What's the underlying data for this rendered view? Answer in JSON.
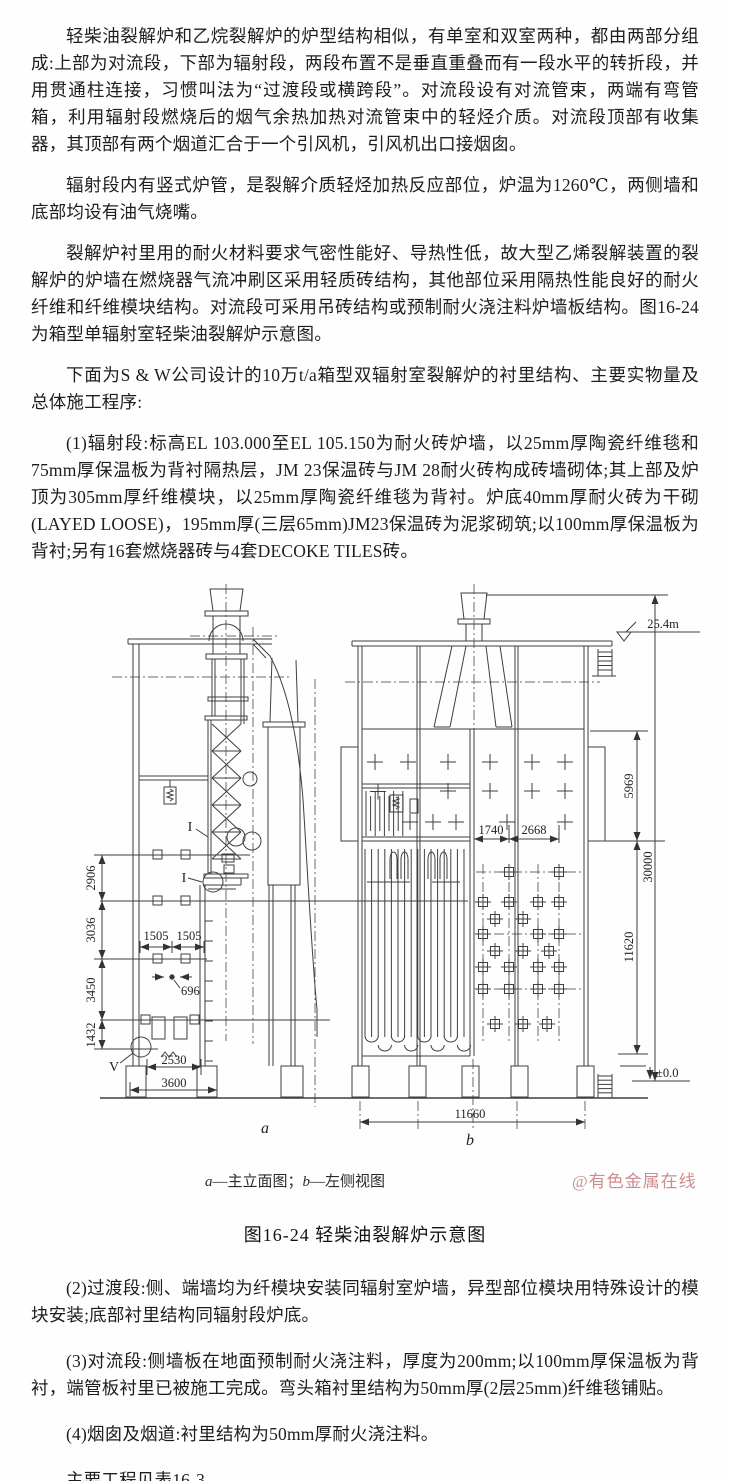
{
  "page": {
    "background": "#fefefe",
    "ink": "#1d1d1d",
    "line_color": "#3f3f3f",
    "watermark_color": "#d08c8c"
  },
  "paragraphs_top": [
    "轻柴油裂解炉和乙烷裂解炉的炉型结构相似，有单室和双室两种，都由两部分组成:上部为对流段，下部为辐射段，两段布置不是垂直重叠而有一段水平的转折段，并用贯通柱连接，习惯叫法为“过渡段或横跨段”。对流段设有对流管束，两端有弯管箱，利用辐射段燃烧后的烟气余热加热对流管束中的轻烃介质。对流段顶部有收集器，其顶部有两个烟道汇合于一个引风机，引风机出口接烟囱。",
    "辐射段内有竖式炉管，是裂解介质轻烃加热反应部位，炉温为1260℃，两侧墙和底部均设有油气烧嘴。",
    "裂解炉衬里用的耐火材料要求气密性能好、导热性低，故大型乙烯裂解装置的裂解炉的炉墙在燃烧器气流冲刷区采用轻质砖结构，其他部位采用隔热性能良好的耐火纤维和纤维模块结构。对流段可采用吊砖结构或预制耐火浇注料炉墙板结构。图16-24为箱型单辐射室轻柴油裂解炉示意图。",
    "下面为S & W公司设计的10万t/a箱型双辐射室裂解炉的衬里结构、主要实物量及总体施工程序:",
    "(1)辐射段:标高EL 103.000至EL 105.150为耐火砖炉墙，以25mm厚陶瓷纤维毯和75mm厚保温板为背衬隔热层，JM 23保温砖与JM 28耐火砖构成砖墙砌体;其上部及炉顶为305mm厚纤维模块，以25mm厚陶瓷纤维毯为背衬。炉底40mm厚耐火砖为干砌(LAYED LOOSE)，195mm厚(三层65mm)JM23保温砖为泥浆砌筑;以100mm厚保温板为背衬;另有16套燃烧器砖与4套DECOKE TILES砖。"
  ],
  "figure": {
    "legend": {
      "a_key": "a",
      "a_text": "—主立面图；",
      "b_key": "b",
      "b_text": "—左侧视图"
    },
    "watermark": "@有色金属在线",
    "caption": "图16-24 轻柴油裂解炉示意图",
    "view_labels": {
      "a": "a",
      "b": "b"
    },
    "detail_labels": {
      "i1": "I",
      "i2": "I",
      "v": "V"
    },
    "dimensions": {
      "left_chain": [
        "2906",
        "3036",
        "3450",
        "1432"
      ],
      "width_1505_a": "1505",
      "width_1505_b": "1505",
      "width_696": "696",
      "width_2530": "2530",
      "width_3600": "3600",
      "elevation_top": "25.4m",
      "height_5969": "5969",
      "height_30000": "30000",
      "height_11620": "11620",
      "elevation_zero": "±0.0",
      "span_1740": "1740",
      "span_2668": "2668",
      "width_11660": "11660"
    }
  },
  "paragraphs_bottom": [
    "(2)过渡段:侧、端墙均为纤模块安装同辐射室炉墙，异型部位模块用特殊设计的模块安装;底部衬里结构同辐射段炉底。",
    "(3)对流段:侧墙板在地面预制耐火浇注料，厚度为200mm;以100mm厚保温板为背衬，端管板衬里已被施工完成。弯头箱衬里结构为50mm厚(2层25mm)纤维毯铺贴。",
    "(4)烟囱及烟道:衬里结构为50mm厚耐火浇注料。",
    "主要工程见表16-3。",
    "总体施工程序如图16-25所示。"
  ]
}
